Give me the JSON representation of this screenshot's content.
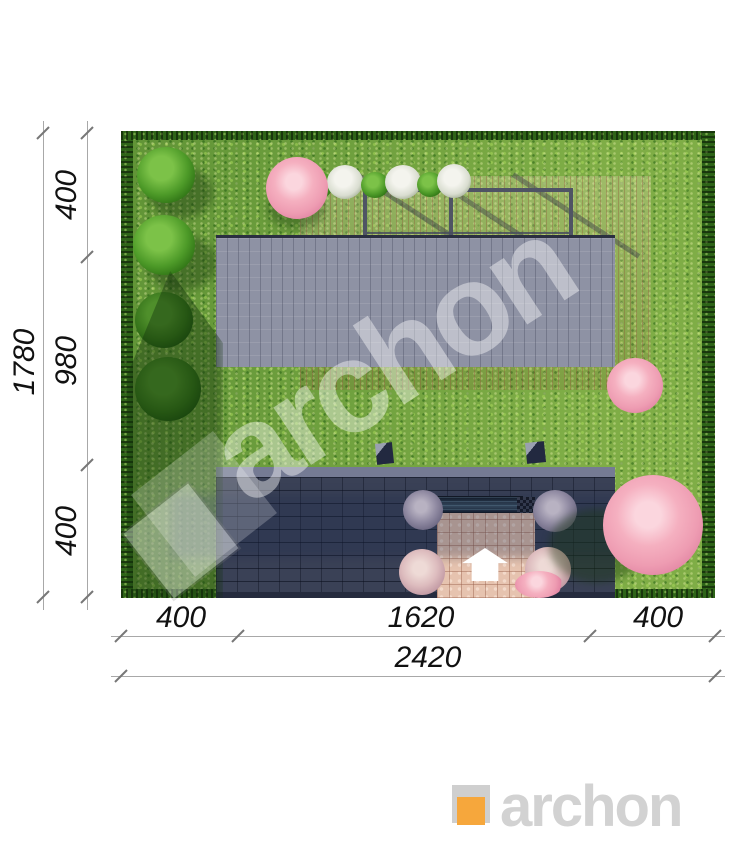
{
  "plan_view": {
    "watermark_text": "archon",
    "left_dimension": {
      "total": "1780",
      "segments": [
        "400",
        "980",
        "400"
      ]
    },
    "bottom_dimension": {
      "total": "2420",
      "segments": [
        "400",
        "1620",
        "400"
      ]
    }
  },
  "branding": {
    "logo_text": "archon",
    "logo_orange": "#F6A73C",
    "logo_gray": "#D2D2D2"
  }
}
